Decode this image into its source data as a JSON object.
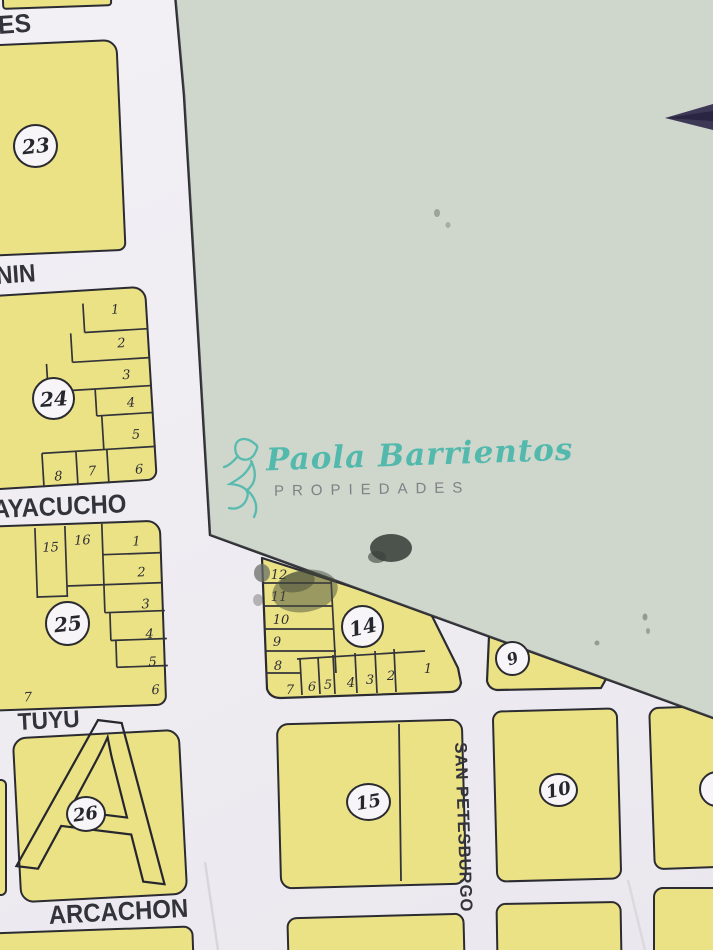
{
  "map": {
    "streets": {
      "es": "ES",
      "nin": "NIN",
      "ayacucho": "AYACUCHO",
      "tuyu": "TUYU",
      "arcachon": "ARCACHON",
      "san_petesburgo": "SAN PETESBURGO"
    },
    "blocks": {
      "b23": {
        "number": "23"
      },
      "b24": {
        "number": "24",
        "lots": [
          "1",
          "2",
          "3",
          "4",
          "5",
          "6",
          "7",
          "8"
        ]
      },
      "b25": {
        "number": "25",
        "lots": [
          "15",
          "16",
          "1",
          "2",
          "3",
          "4",
          "5",
          "6",
          "7"
        ]
      },
      "b26": {
        "number": "26"
      },
      "b14": {
        "number": "14",
        "lots": [
          "12",
          "11",
          "10",
          "9",
          "8",
          "7",
          "6",
          "5",
          "4",
          "3",
          "2",
          "1"
        ]
      },
      "b15": {
        "number": "15"
      },
      "b9": {
        "number": "9"
      },
      "b10": {
        "number": "10"
      }
    },
    "overlay_letter": "A"
  },
  "watermark": {
    "brand": "Paola Barrientos",
    "subtitle": "PROPIEDADES"
  },
  "colors": {
    "block_fill": "#ebe285",
    "map_line": "#2b2b32",
    "green_overlay": "#cdd4c9",
    "paper": "#f0eef3",
    "watermark_teal": "#49b7ab",
    "watermark_gray": "#7f8186",
    "pen": "#3e3857"
  }
}
